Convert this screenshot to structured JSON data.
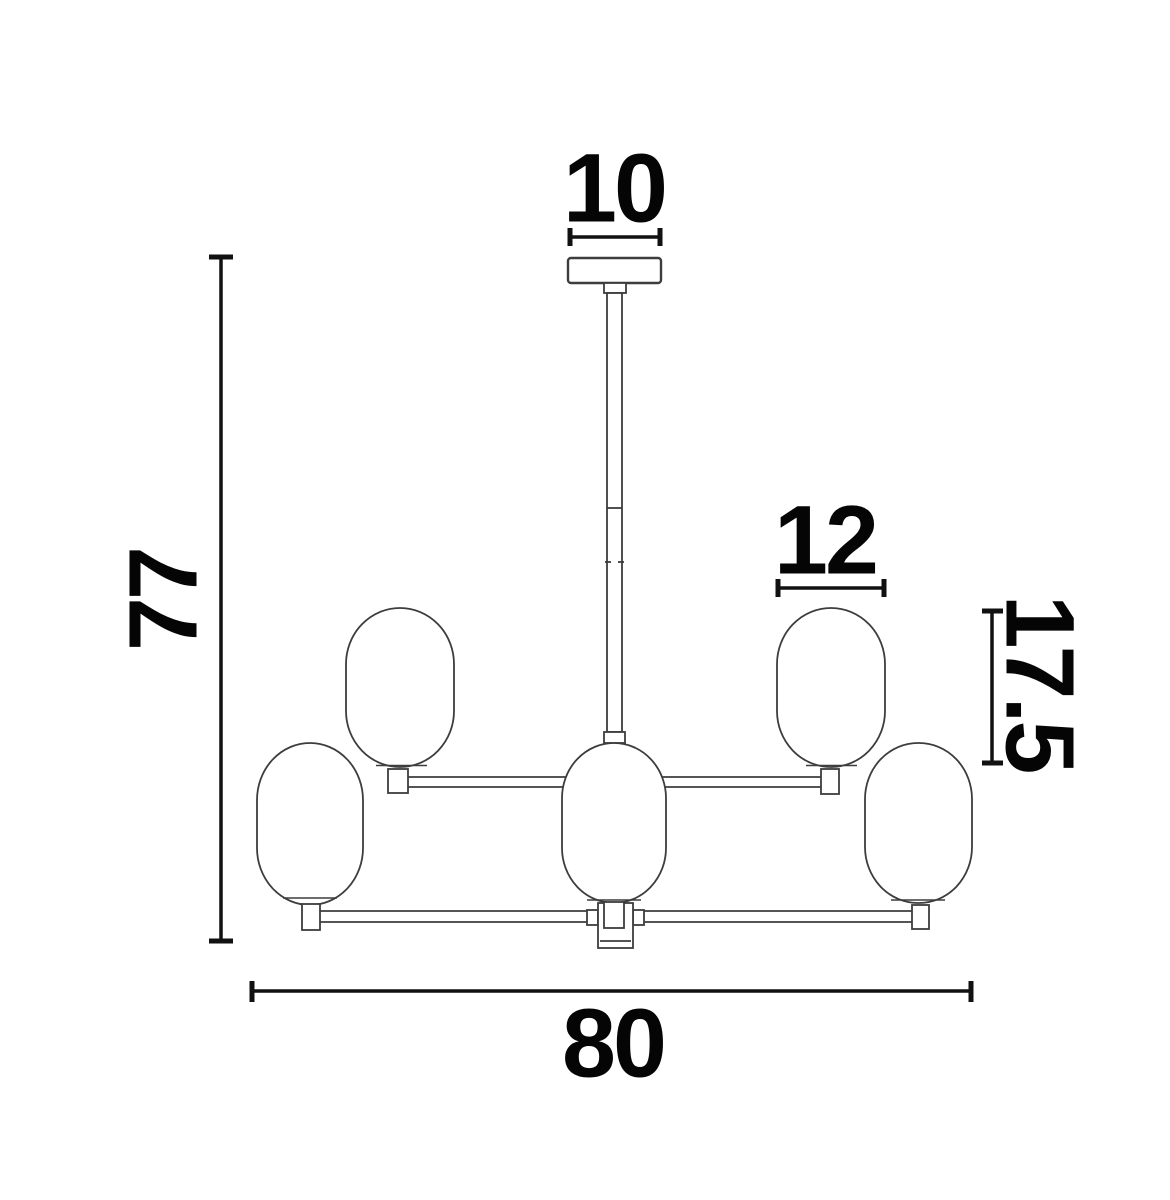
{
  "drawing": {
    "title": "Chandelier technical dimension drawing, front view, 5 oval glass shades on two-tier arms",
    "background_color": "#ffffff",
    "outline_color": "#3d3d3d",
    "dimension_color": "#111111",
    "text_color": "#050505"
  },
  "dimensions": {
    "canopy_width": "10",
    "overall_height": "77",
    "shade_width": "12",
    "shade_height": "17.5",
    "overall_width": "80"
  }
}
